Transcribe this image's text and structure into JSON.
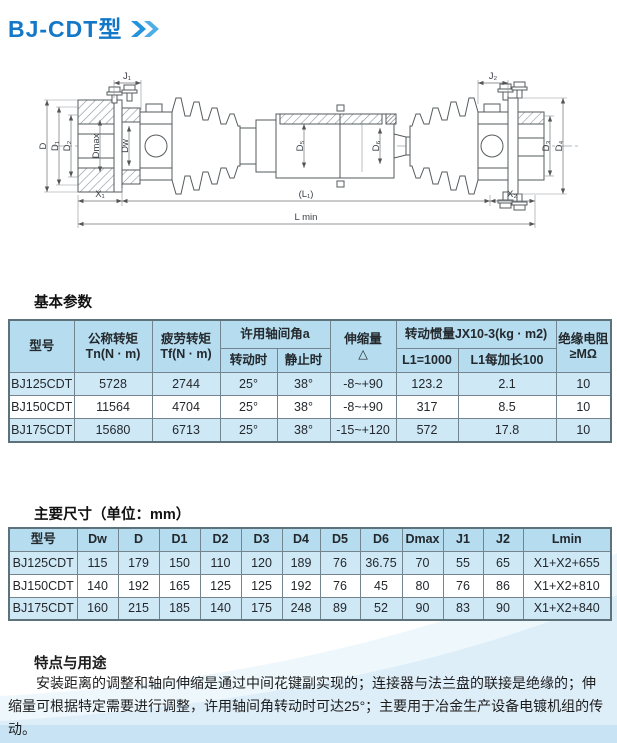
{
  "header": {
    "title": "BJ-CDT型",
    "chevron_icon": "double-chevron"
  },
  "drawing": {
    "labels": {
      "j1": "J₁",
      "j2": "J₂",
      "d": "D",
      "d1": "D₁",
      "d2": "D₂",
      "dmax": "Dmax",
      "dw": "Dw",
      "d5": "D₅",
      "d6": "D₆",
      "d3": "D₃",
      "d4": "D₄",
      "x1": "X₁",
      "l1": "(L₁)",
      "x2": "X₂",
      "lmin": "L min"
    }
  },
  "basic": {
    "section_title": "基本参数",
    "headers": {
      "model": "型号",
      "tn_line1": "公称转矩",
      "tn_line2": "Tn(N · m)",
      "tf_line1": "疲劳转矩",
      "tf_line2": "Tf(N · m)",
      "angle_group": "许用轴间角a",
      "angle_rotating": "转动时",
      "angle_static": "静止时",
      "stretch_line1": "伸缩量",
      "stretch_line2": "△",
      "inertia_group": "转动惯量JX10-3(kg · m2)",
      "inertia_l1000": "L1=1000",
      "inertia_per100": "L1每加长100",
      "resist_line1": "绝缘电阻",
      "resist_line2": "≥MΩ"
    },
    "rows": [
      [
        "BJ125CDT",
        "5728",
        "2744",
        "25°",
        "38°",
        "-8~+90",
        "123.2",
        "2.1",
        "10"
      ],
      [
        "BJ150CDT",
        "11564",
        "4704",
        "25°",
        "38°",
        "-8~+90",
        "317",
        "8.5",
        "10"
      ],
      [
        "BJ175CDT",
        "15680",
        "6713",
        "25°",
        "38°",
        "-15~+120",
        "572",
        "17.8",
        "10"
      ]
    ]
  },
  "dims": {
    "section_title": "主要尺寸（单位：mm）",
    "headers": [
      "型号",
      "Dw",
      "D",
      "D1",
      "D2",
      "D3",
      "D4",
      "D5",
      "D6",
      "Dmax",
      "J1",
      "J2",
      "Lmin"
    ],
    "rows": [
      [
        "BJ125CDT",
        "115",
        "179",
        "150",
        "110",
        "120",
        "189",
        "76",
        "36.75",
        "70",
        "55",
        "65",
        "X1+X2+655"
      ],
      [
        "BJ150CDT",
        "140",
        "192",
        "165",
        "125",
        "125",
        "192",
        "76",
        "45",
        "80",
        "76",
        "86",
        "X1+X2+810"
      ],
      [
        "BJ175CDT",
        "160",
        "215",
        "185",
        "140",
        "175",
        "248",
        "89",
        "52",
        "90",
        "83",
        "90",
        "X1+X2+840"
      ]
    ]
  },
  "features": {
    "title": "特点与用途",
    "body": "安装距离的调整和轴向伸缩是通过中间花键副实现的；连接器与法兰盘的联接是绝缘的；伸缩量可根据特定需要进行调整，许用轴间角转动时可达25°；主要用于冶金生产设备电镀机组的传动。"
  },
  "colors": {
    "title_blue": "#1478c8",
    "chevron_blue": "#3ea2e2",
    "table_header_bg": "#b5dcef",
    "table_row_alt_bg": "#cfe8f6",
    "table_border": "#72858f"
  }
}
